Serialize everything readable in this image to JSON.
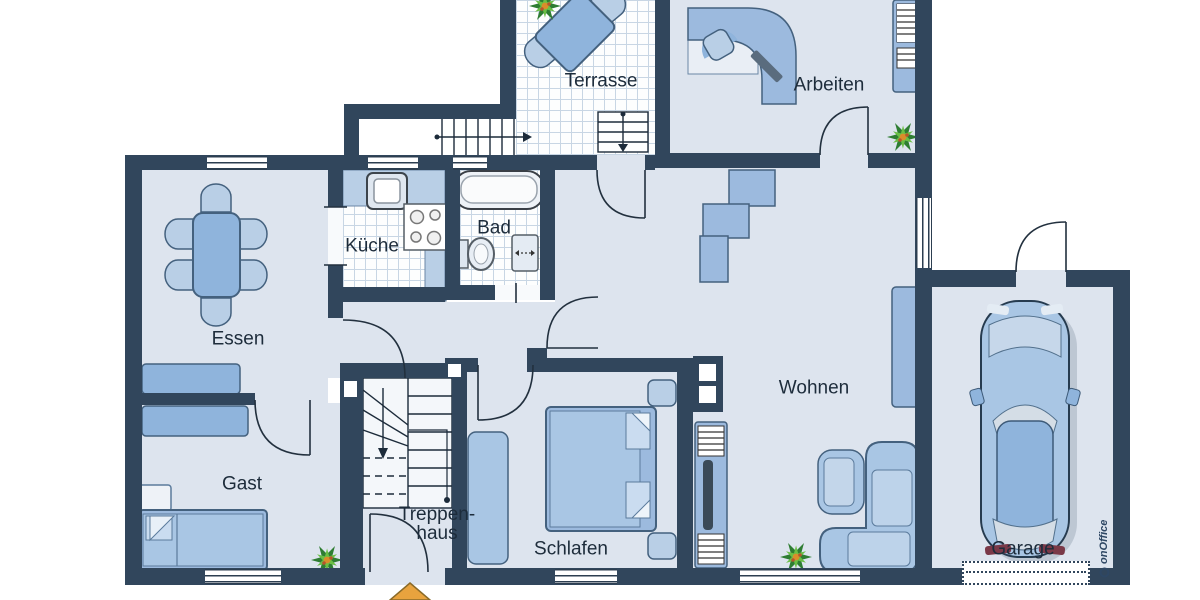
{
  "rooms": [
    {
      "id": "terrasse",
      "label": "Terrasse"
    },
    {
      "id": "arbeiten",
      "label": "Arbeiten"
    },
    {
      "id": "kueche",
      "label": "Küche"
    },
    {
      "id": "bad",
      "label": "Bad"
    },
    {
      "id": "essen",
      "label": "Essen"
    },
    {
      "id": "wohnen",
      "label": "Wohnen"
    },
    {
      "id": "gast",
      "label": "Gast"
    },
    {
      "id": "treppenhaus",
      "label_line1": "Treppen-",
      "label_line2": "haus"
    },
    {
      "id": "schlafen",
      "label": "Schlafen"
    },
    {
      "id": "garage",
      "label": "Garage"
    }
  ],
  "watermark": {
    "text": "onOffice"
  },
  "colors": {
    "wall": "#31465c",
    "floor": "#dde4ee",
    "tile_line": "#c8d6e4",
    "furniture": "#8fb4dc",
    "furniture_light": "#b9cfe6",
    "furniture_outline": "#44617e",
    "label_text": "#1d2c3b",
    "plant_dark": "#2e7d32",
    "plant_light": "#6abf45",
    "entrance_arrow": "#e8a33e",
    "car_body": "#a9c6e4"
  }
}
